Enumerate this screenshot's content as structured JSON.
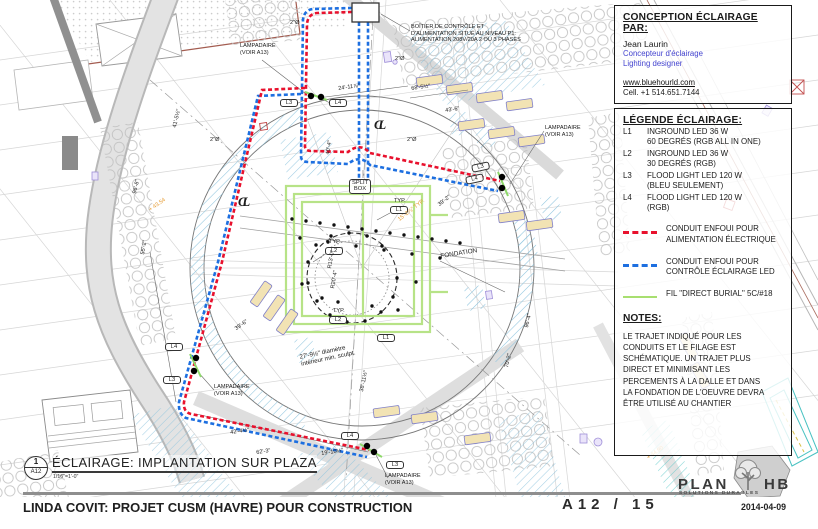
{
  "colors": {
    "conduit_power_red": "#e8112d",
    "conduit_control_blue": "#1d6fe0",
    "wire_green": "#a8df70",
    "hatch_blue": "#8fc4de",
    "hatch_teal": "#57c7c7",
    "bench_tan": "#f2e3b4",
    "elevation_orange": "#e59a2f",
    "link_blue": "#4343cf"
  },
  "conception": {
    "title": "CONCEPTION ÉCLAIRAGE PAR:",
    "designer": "Jean Laurin",
    "role_fr": "Concepteur d'éclairage",
    "role_en": "Lighting designer",
    "website": "www.bluehourld.com",
    "phone": "Cell. +1 514.651.7144"
  },
  "legend": {
    "title": "LÉGENDE ÉCLAIRAGE:",
    "items": [
      {
        "code": "L1",
        "line1": "INGROUND  LED 36 W",
        "line2": "60 DEGRÉS  (RGB ALL IN ONE)"
      },
      {
        "code": "L2",
        "line1": "INGROUND  LED 36 W",
        "line2": "30 DEGRÉS  (RGB)"
      },
      {
        "code": "L3",
        "line1": "FLOOD LIGHT  LED 120 W",
        "line2": "(BLEU SEULEMENT)"
      },
      {
        "code": "L4",
        "line1": "FLOOD LIGHT  LED 120 W",
        "line2": "(RGB)"
      }
    ],
    "conduits": [
      {
        "swatch": "red-dashed",
        "text": "CONDUIT ENFOUI POUR\nALIMENTATION ÉLECTRIQUE"
      },
      {
        "swatch": "blue-dashed",
        "text": "CONDUIT ENFOUI POUR\nCONTRÔLE ÉCLAIRAGE LED"
      },
      {
        "swatch": "green-solid",
        "text": "FIL \"DIRECT BURIAL\" 5C/#18"
      }
    ]
  },
  "notes": {
    "title": "NOTES:",
    "body": "LE TRAJET INDIQUÉ POUR LES\nCONDUITS ET LE FILAGE EST\nSCHÉMATIQUE. UN TRAJET PLUS\nDIRECT ET MINIMISANT LES\nPERCEMENTS À LA DALLE ET DANS\nLA FONDATION DE L'OEUVRE DEVRA\nÊTRE UTILISÉ AU CHANTIER"
  },
  "titleblock": {
    "figure_number": "1",
    "figure_sheet": "A12",
    "scale": "1/16\"=1'-0\"",
    "title": "ÉCLAIRAGE: IMPLANTATION SUR PLAZA",
    "project": "LINDA COVIT: PROJET CUSM (HAVRE) POUR CONSTRUCTION",
    "sheet_number": "A12 / 15",
    "logo_plan": "PLAN",
    "logo_hb": "HB",
    "logo_sub": "SOLUTIONS DURABLES",
    "date": "2014-04-09"
  },
  "drawing": {
    "annotations": [
      {
        "name": "boitier-note",
        "cls": "note",
        "x": 411,
        "y": 24,
        "w": 132,
        "text": "BOÎTIER DE CONTRÔLE ET\nD'ALIMENTATION SITUÉ AU NIVEAU P1:\nALIMENTATION 208V/20A 2 OU 3 PHASES"
      },
      {
        "name": "lampadaire-label-nw",
        "cls": "note",
        "x": 240,
        "y": 43,
        "text": "LAMPADAIRE\n(VOIR A13)"
      },
      {
        "name": "lampadaire-label-e",
        "cls": "note",
        "x": 545,
        "y": 125,
        "text": "LAMPADAIRE\n(VOIR A13)"
      },
      {
        "name": "lampadaire-label-w",
        "cls": "note",
        "x": 214,
        "y": 384,
        "text": "LAMPADAIRE\n(VOIR A13)"
      },
      {
        "name": "lampadaire-label-s",
        "cls": "note",
        "x": 385,
        "y": 473,
        "text": "LAMPADAIRE\n(VOIR A13)"
      },
      {
        "name": "split-box-tag",
        "cls": "tag",
        "x": 349,
        "y": 179,
        "text": "SPLIT\nBOX"
      },
      {
        "name": "typ-label-1",
        "cls": "dim",
        "x": 394,
        "y": 198,
        "text": "TYP."
      },
      {
        "name": "tag-l1",
        "cls": "tag",
        "x": 390,
        "y": 206,
        "text": "L1"
      },
      {
        "name": "typ-label-2",
        "cls": "dim",
        "x": 329,
        "y": 239,
        "text": "TYP."
      },
      {
        "name": "tag-l2-west",
        "cls": "tag",
        "x": 325,
        "y": 247,
        "text": "L2"
      },
      {
        "name": "typ-label-3",
        "cls": "dim",
        "x": 333,
        "y": 308,
        "text": "TYP."
      },
      {
        "name": "tag-l2-south",
        "cls": "tag",
        "x": 329,
        "y": 316,
        "text": "L2"
      },
      {
        "name": "tag-l1-south",
        "cls": "tag",
        "x": 377,
        "y": 334,
        "text": "L1"
      },
      {
        "name": "fondation-label",
        "cls": "dim",
        "x": 440,
        "y": 253,
        "rot": -9,
        "fs": 6.4,
        "text": "FONDATION"
      },
      {
        "name": "tag-l3-north",
        "cls": "tag",
        "x": 280,
        "y": 99,
        "text": "L3"
      },
      {
        "name": "tag-l4-north",
        "cls": "tag",
        "x": 329,
        "y": 99,
        "text": "L4"
      },
      {
        "name": "tag-l3-east",
        "cls": "tag",
        "x": 471,
        "y": 165,
        "rot": -12,
        "text": "L3"
      },
      {
        "name": "tag-l4-east",
        "cls": "tag",
        "x": 465,
        "y": 177,
        "rot": -12,
        "text": "L4"
      },
      {
        "name": "tag-l4-west",
        "cls": "tag",
        "x": 165,
        "y": 343,
        "text": "L4"
      },
      {
        "name": "tag-l3-west",
        "cls": "tag",
        "x": 163,
        "y": 376,
        "text": "L3"
      },
      {
        "name": "tag-l4-sw",
        "cls": "tag",
        "x": 341,
        "y": 432,
        "text": "L4"
      },
      {
        "name": "tag-l3-sw",
        "cls": "tag",
        "x": 386,
        "y": 461,
        "text": "L3"
      },
      {
        "name": "dim-24-11",
        "cls": "dim",
        "x": 338,
        "y": 86,
        "rot": -8,
        "text": "24'-11⅞\""
      },
      {
        "name": "dim-68-5",
        "cls": "dim",
        "x": 411,
        "y": 86,
        "rot": -8,
        "text": "68'-5½\""
      },
      {
        "name": "dim-43-6",
        "cls": "dim",
        "x": 445,
        "y": 108,
        "rot": -8,
        "text": "43'-6\""
      },
      {
        "name": "dim-39-2",
        "cls": "dim",
        "x": 437,
        "y": 203,
        "rot": -38,
        "text": "39'-2\""
      },
      {
        "name": "dim-15-2",
        "cls": "dimo",
        "x": 397,
        "y": 218,
        "rot": -38,
        "text": "15'-2⅞\" TYP."
      },
      {
        "name": "dim-r13",
        "cls": "dim",
        "x": 327,
        "y": 268,
        "rot": -80,
        "text": "R13'-0\""
      },
      {
        "name": "dim-r20",
        "cls": "dim",
        "x": 330,
        "y": 288,
        "rot": -80,
        "text": "R20'-4\""
      },
      {
        "name": "dim-27-9",
        "cls": "note",
        "x": 299,
        "y": 354,
        "rot": -12,
        "fs": 6.2,
        "text": "27'-9½\" diamètre\nintérieur min. sculpt."
      },
      {
        "name": "dim-39-6",
        "cls": "dim",
        "x": 234,
        "y": 327,
        "rot": -35,
        "text": "39'-6\""
      },
      {
        "name": "dim-42-4",
        "cls": "dim",
        "x": 230,
        "y": 430,
        "rot": -8,
        "text": "42'-4½\""
      },
      {
        "name": "dim-62-3",
        "cls": "dim",
        "x": 256,
        "y": 450,
        "rot": -8,
        "text": "62'-3\""
      },
      {
        "name": "dim-19-10",
        "cls": "dim",
        "x": 321,
        "y": 451,
        "rot": -8,
        "text": "19'-10½\""
      },
      {
        "name": "dim-38-11",
        "cls": "dim",
        "x": 359,
        "y": 391,
        "rot": -78,
        "text": "38'-11½\""
      },
      {
        "name": "dim-55-2",
        "cls": "dim",
        "x": 140,
        "y": 254,
        "rot": -80,
        "text": "55'-2\""
      },
      {
        "name": "dim-40-4",
        "cls": "dim",
        "x": 325,
        "y": 154,
        "rot": -80,
        "text": "40'-4\""
      },
      {
        "name": "dim-41-5",
        "cls": "dim",
        "x": 172,
        "y": 127,
        "rot": -77,
        "text": "41'-5½\""
      },
      {
        "name": "dim-96-8",
        "cls": "dim",
        "x": 132,
        "y": 193,
        "rot": -77,
        "text": "96'-8\""
      },
      {
        "name": "dim-70-2",
        "cls": "dim",
        "x": 504,
        "y": 367,
        "rot": -77,
        "text": "70'-2\""
      },
      {
        "name": "dim-96-4",
        "cls": "dim",
        "x": 524,
        "y": 327,
        "rot": -77,
        "text": "96'-4\""
      },
      {
        "name": "dia-2-a",
        "cls": "dim",
        "x": 290,
        "y": 20,
        "text": "2\"Ø"
      },
      {
        "name": "dia-2-b",
        "cls": "dim",
        "x": 395,
        "y": 56,
        "text": "2\"Ø"
      },
      {
        "name": "dia-2-c",
        "cls": "dim",
        "x": 210,
        "y": 137,
        "text": "2\"Ø"
      },
      {
        "name": "dia-2-d",
        "cls": "dim",
        "x": 407,
        "y": 137,
        "text": "2\"Ø"
      },
      {
        "name": "elev-43-54",
        "cls": "dimo",
        "x": 148,
        "y": 208,
        "rot": -35,
        "text": "+ 43.54"
      },
      {
        "name": "elev-44-90",
        "cls": "dimo",
        "x": 646,
        "y": 456,
        "rot": -35,
        "text": "+ 44.90"
      },
      {
        "name": "centerline-symbol-1",
        "cls": "cl",
        "x": 374,
        "y": 117,
        "text": "CL"
      },
      {
        "name": "centerline-symbol-2",
        "cls": "cl",
        "x": 238,
        "y": 194,
        "text": "CL"
      }
    ]
  }
}
